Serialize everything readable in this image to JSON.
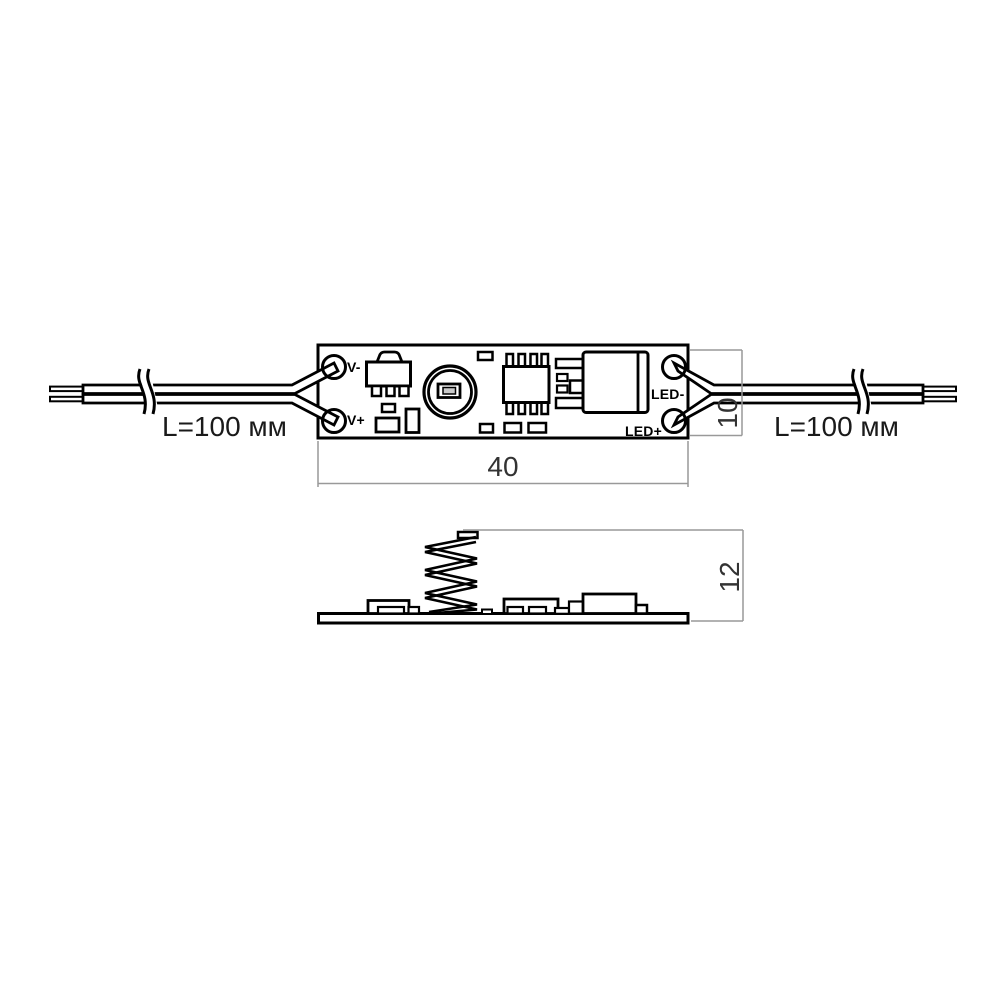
{
  "top_view": {
    "pad_labels": {
      "top_left": "V-",
      "bottom_left": "V+",
      "top_right": "LED-",
      "bottom_right": "LED+"
    },
    "left_wire": {
      "length_label": "L=100 мм"
    },
    "right_wire": {
      "length_label": "L=100 мм"
    },
    "dimensions": {
      "width": "40",
      "height": "10"
    }
  },
  "side_view": {
    "dimensions": {
      "height": "12"
    }
  },
  "colors": {
    "outline": "#000000",
    "dimension_line": "#999999",
    "dimension_text": "#333333",
    "background": "#ffffff",
    "led_window_fill": "#c9c9c9"
  }
}
